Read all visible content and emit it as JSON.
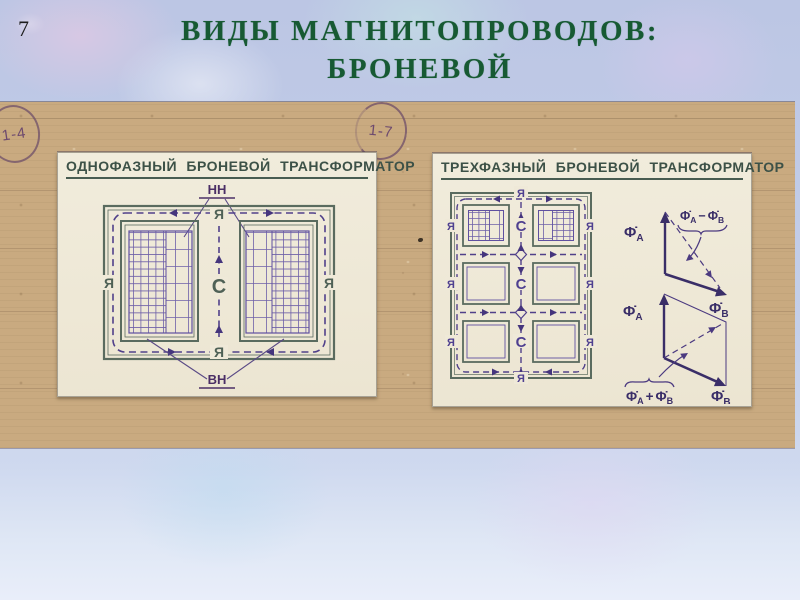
{
  "slide": {
    "page_number": "7",
    "title_line1": "ВИДЫ МАГНИТОПРОВОДОВ:",
    "title_line2": "БРОНЕВОЙ"
  },
  "scan": {
    "ref_left": "1-4",
    "ref_right": "1-7",
    "single_phase": {
      "title": "ОДНОФАЗНЫЙ БРОНЕВОЙ ТРАНСФОРМАТОР",
      "winding_top_label": "НН",
      "winding_bottom_label": "ВН",
      "yoke_label": "Я",
      "core_label": "С"
    },
    "three_phase": {
      "title": "ТРЕХФАЗНЫЙ БРОНЕВОЙ ТРАНСФОРМАТОР",
      "yoke_label": "Я",
      "core_label": "С",
      "vectors": {
        "phi": "Φ̇",
        "sub_a": "A",
        "sub_b": "B",
        "minus": "−",
        "plus": "+"
      }
    }
  },
  "colors": {
    "title_green": "#175a33",
    "panel_title_green": "#3c5147",
    "core_outline_green": "#5a6b5f",
    "ink_purple": "#4b3a80",
    "cardboard_tan": "#c9aa80",
    "paper_cream": "#efe9d8",
    "background_blue": "#c4cfe9"
  }
}
